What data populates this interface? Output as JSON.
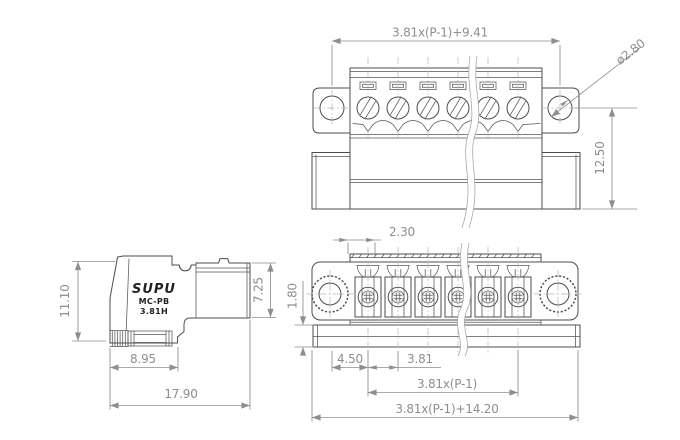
{
  "drawing": {
    "product": {
      "brand": "SUPU",
      "series": "MC-PB",
      "pitch_code": "3.81H"
    },
    "views": {
      "front": {
        "dims": {
          "width_formula": "3.81x(P-1)+9.41",
          "hole_diameter": "ø2.80",
          "height": "12.50"
        }
      },
      "side": {
        "dims": {
          "height": "11.10",
          "plug_height": "7.25",
          "depth_front": "8.95",
          "depth_total": "17.90"
        }
      },
      "bottom": {
        "dims": {
          "slot_offset": "2.30",
          "rail_height": "1.80",
          "end_offset": "4.50",
          "pitch": "3.81",
          "span_formula": "3.81x(P-1)",
          "width_formula": "3.81x(P-1)+14.20"
        }
      }
    },
    "colors": {
      "object_line": "#4d4d4d",
      "dimension": "#8e8e8e",
      "logo_text": "#222222",
      "background": "#ffffff"
    }
  }
}
